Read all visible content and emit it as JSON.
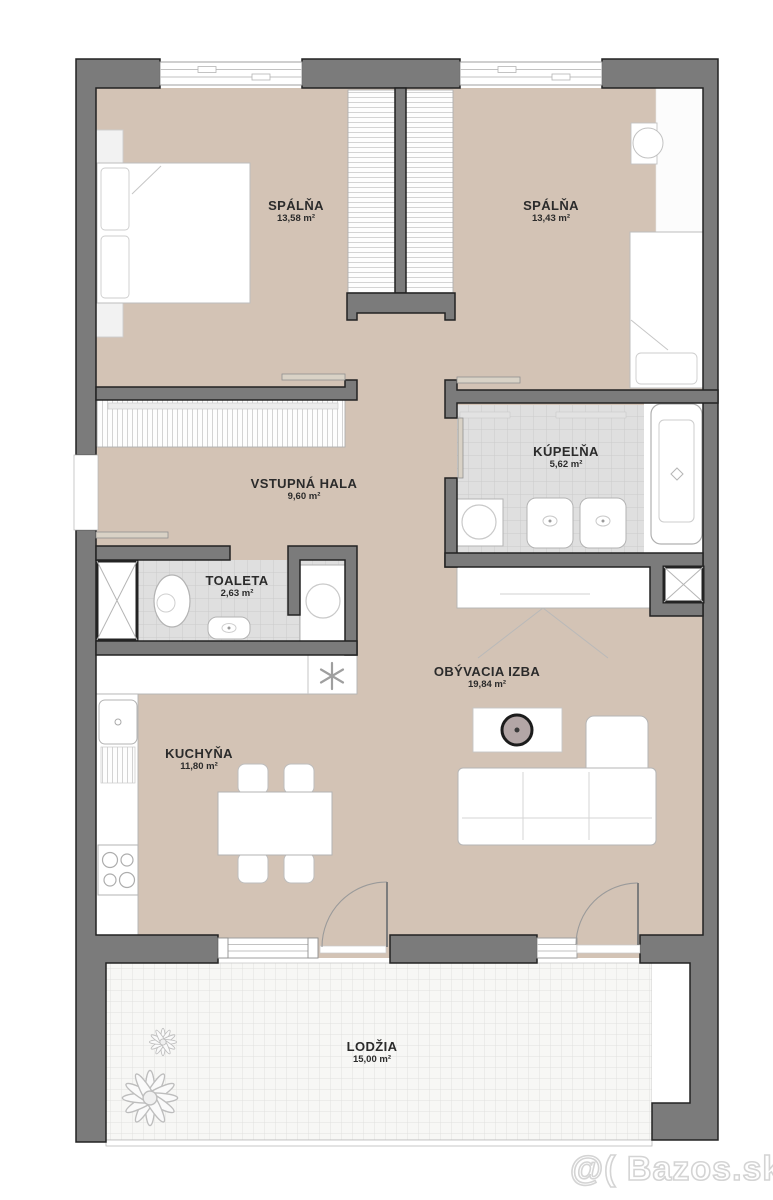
{
  "rooms": [
    {
      "id": "spalna-1",
      "name": "SPÁLŇA",
      "area": "13,58 m²"
    },
    {
      "id": "spalna-2",
      "name": "SPÁLŇA",
      "area": "13,43 m²"
    },
    {
      "id": "vstupna-hala",
      "name": "VSTUPNÁ HALA",
      "area": "9,60 m²"
    },
    {
      "id": "kupelna",
      "name": "KÚPEĽŇA",
      "area": "5,62 m²"
    },
    {
      "id": "toaleta",
      "name": "TOALETA",
      "area": "2,63 m²"
    },
    {
      "id": "obyvacia-izba",
      "name": "OBÝVACIA IZBA",
      "area": "19,84 m²"
    },
    {
      "id": "kuchyna",
      "name": "KUCHYŇA",
      "area": "11,80 m²"
    },
    {
      "id": "lodzia",
      "name": "LODŽIA",
      "area": "15,00 m²"
    }
  ],
  "icons": {
    "freezer": "snowflake-asterisk",
    "plants": "loggia-plants",
    "shafts": "diagonal-cross-shaft"
  },
  "watermark": {
    "text": "@( Bazos.sk"
  },
  "colors": {
    "floor": "#d3c3b5",
    "wall": "#7b7b7b",
    "wall_outline": "#232323",
    "bath_tile": "#dfdfdf",
    "loggia_tile": "#f7f7f5",
    "furniture_stroke": "#b5b5b5"
  }
}
